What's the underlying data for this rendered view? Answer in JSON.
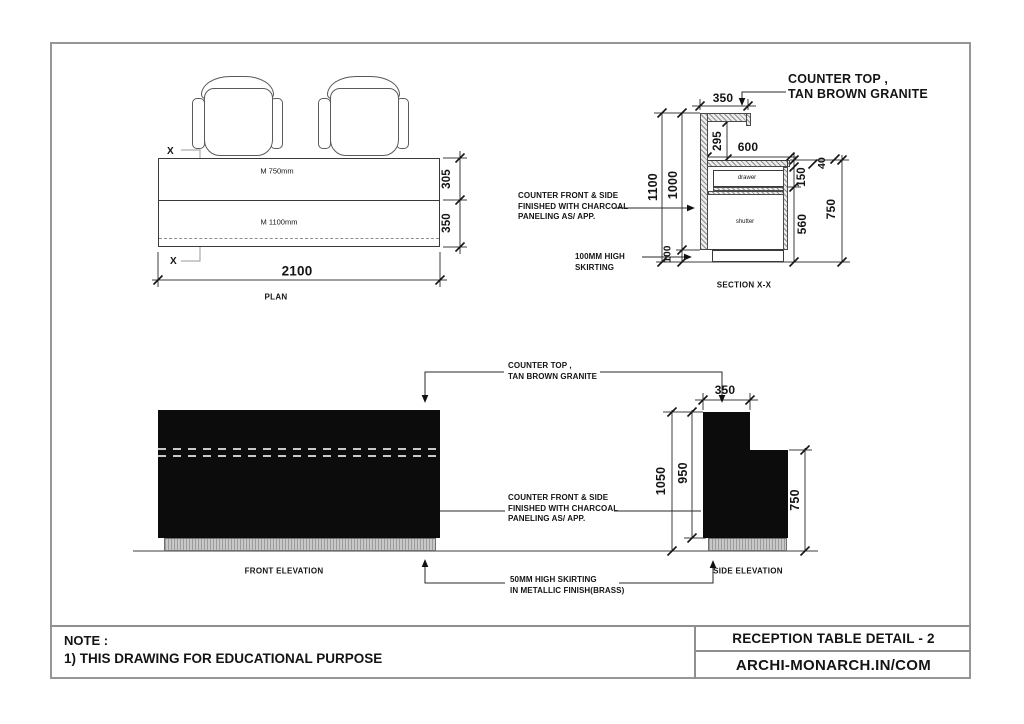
{
  "plan": {
    "caption": "PLAN",
    "section_marker": "X",
    "row1_label": "M 750mm",
    "row2_label": "M 1100mm",
    "dim_width": "2100",
    "dim_row1_depth": "305",
    "dim_row2_depth": "350"
  },
  "section": {
    "caption": "SECTION X-X",
    "counter_callout": [
      "COUNTER TOP ,",
      "TAN BROWN GRANITE"
    ],
    "front_callout": [
      "COUNTER FRONT & SIDE",
      "FINISHED WITH CHARCOAL",
      "PANELING AS/ APP."
    ],
    "skirting_callout": [
      "100MM HIGH",
      "SKIRTING"
    ],
    "drawer_label": "drawer",
    "shutter_label": "shutter",
    "dim_counter_width": "350",
    "dim_counter_drop": "295",
    "dim_desk_depth": "600",
    "dim_top_thickness": "40",
    "dim_drawer_height": "150",
    "dim_shutter_height": "560",
    "dim_desk_height": "750",
    "dim_total_height": "1100",
    "dim_carcass_height": "1000",
    "dim_skirting_height": "100"
  },
  "front_elevation": {
    "caption": "FRONT ELEVATION",
    "counter_callout": [
      "COUNTER TOP ,",
      "TAN BROWN GRANITE"
    ],
    "front_callout": [
      "COUNTER FRONT & SIDE",
      "FINISHED WITH CHARCOAL",
      "PANELING AS/ APP."
    ],
    "skirting_callout": [
      "50MM HIGH SKIRTING",
      "IN METALLIC FINISH(BRASS)"
    ]
  },
  "side_elevation": {
    "caption": "SIDE ELEVATION",
    "dim_top_width": "350",
    "dim_total_height": "1050",
    "dim_body_height": "950",
    "dim_desk_height": "750"
  },
  "title_block": {
    "note_title": "NOTE :",
    "note_line1": "1) THIS DRAWING FOR EDUCATIONAL PURPOSE",
    "drawing_title": "RECEPTION TABLE DETAIL - 2",
    "brand": "ARCHI-MONARCH.IN/COM"
  }
}
